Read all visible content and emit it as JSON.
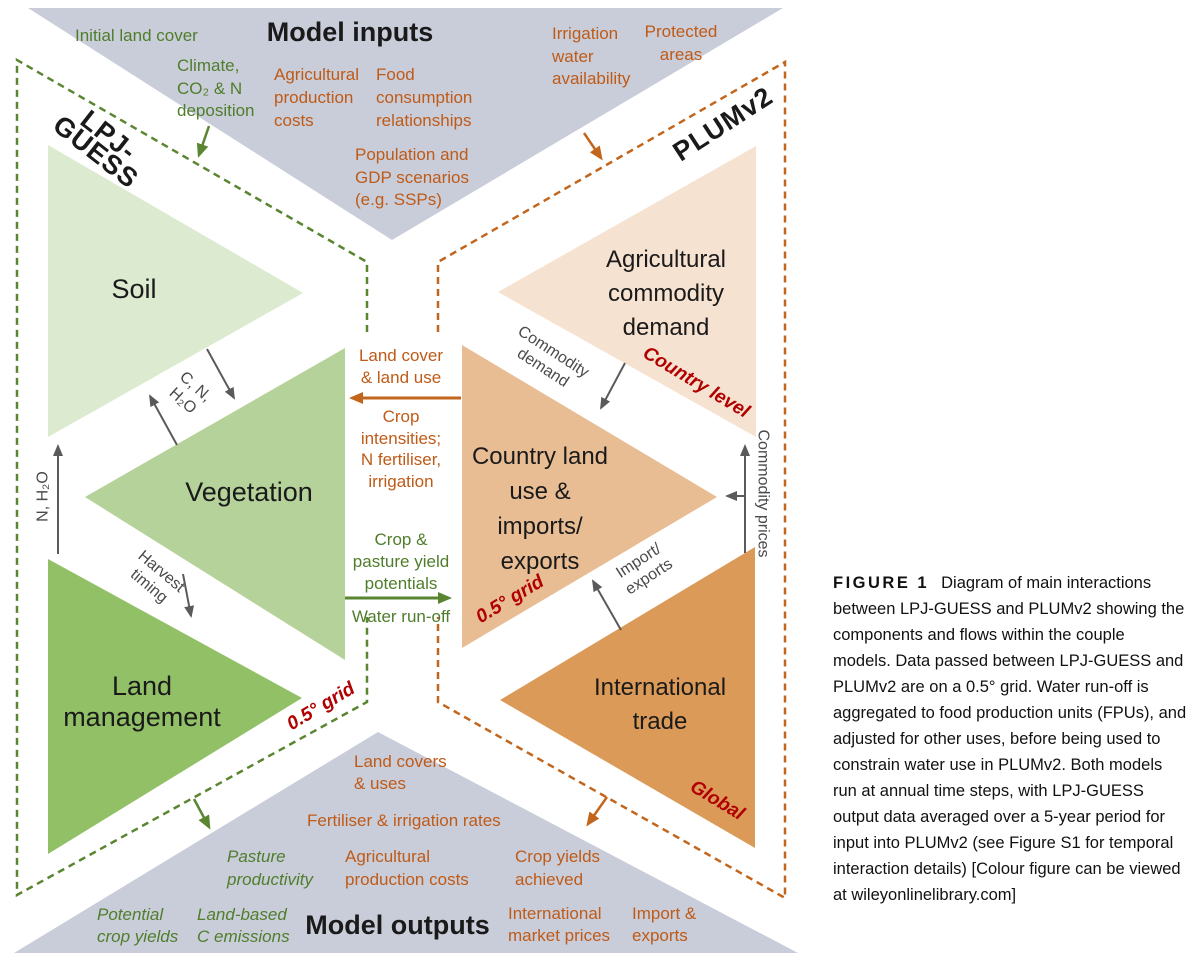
{
  "colors": {
    "green_text": "#4f7d2b",
    "orange_text": "#bf5a17",
    "dark_red": "#b00000",
    "gray_band": "#c9cdd9",
    "arrow_gray": "#5a5a5a",
    "soil_fill": "#dcead0",
    "vegetation_fill": "#b5d29a",
    "land_management_fill": "#92c067",
    "commodity_demand_fill": "#f6e2d0",
    "country_land_use_fill": "#e9bd94",
    "international_trade_fill": "#dc9a58",
    "green_dash": "#5a8631",
    "orange_dash": "#c2661d"
  },
  "titles": {
    "model_inputs": "Model inputs",
    "model_outputs": "Model outputs"
  },
  "models": {
    "lpj_guess": "LPJ-GUESS",
    "plumv2": "PLUMv2"
  },
  "inputs": {
    "initial_land_cover": "Initial land cover",
    "climate_co2_n_deposition": "Climate,\nCO₂ & N\ndeposition",
    "agricultural_production_costs": "Agricultural\nproduction\ncosts",
    "food_consumption_relationships": "Food\nconsumption\nrelationships",
    "population_gdp_scenarios": "Population and\nGDP scenarios\n(e.g. SSPs)",
    "irrigation_water_availability": "Irrigation\nwater\navailability",
    "protected_areas": "Protected\nareas"
  },
  "components": {
    "soil": "Soil",
    "vegetation": "Vegetation",
    "land_management": "Land\nmanagement",
    "agricultural_commodity_demand": "Agricultural\ncommodity\ndemand",
    "country_land_use": "Country land\nuse &\nimports/\nexports",
    "international_trade": "International\ntrade"
  },
  "flows": {
    "c_n_h2o": "C, N,\nH₂O",
    "n_h2o": "N, H₂O",
    "harvest_timing": "Harvest\ntiming",
    "land_cover_land_use": "Land cover\n& land use",
    "crop_intensities": "Crop\nintensities;\nN fertiliser,\nirrigation",
    "crop_pasture_yield_potentials": "Crop &\npasture yield\npotentials",
    "water_runoff": "Water run-off",
    "commodity_demand": "Commodity\ndemand",
    "commodity_prices": "Commodity prices",
    "import_exports": "Import/\nexports"
  },
  "scales": {
    "country_level": "Country level",
    "grid_plumv2": "0.5° grid",
    "grid_lpj": "0.5° grid",
    "global": "Global"
  },
  "outputs": {
    "pasture_productivity": "Pasture\nproductivity",
    "potential_crop_yields": "Potential\ncrop yields",
    "land_based_c_emissions": "Land-based\nC emissions",
    "land_covers_uses": "Land covers\n& uses",
    "fertiliser_irrigation_rates": "Fertiliser & irrigation rates",
    "agricultural_production_costs": "Agricultural\nproduction costs",
    "crop_yields_achieved": "Crop yields\nachieved",
    "international_market_prices": "International\nmarket prices",
    "import_exports": "Import &\nexports"
  },
  "caption": {
    "tag": "FIGURE 1",
    "body": "Diagram of main interactions between LPJ-GUESS and PLUMv2 showing the components and flows within the couple models. Data passed between LPJ-GUESS and PLUMv2 are on a 0.5° grid. Water run-off is aggregated to food production units (FPUs), and adjusted for other uses, before being used to constrain water use in PLUMv2. Both models run at annual time steps, with LPJ-GUESS output data averaged over a 5-year period for input into PLUMv2 (see Figure S1 for temporal interaction details) [Colour figure can be viewed at wileyonlinelibrary.com]"
  }
}
